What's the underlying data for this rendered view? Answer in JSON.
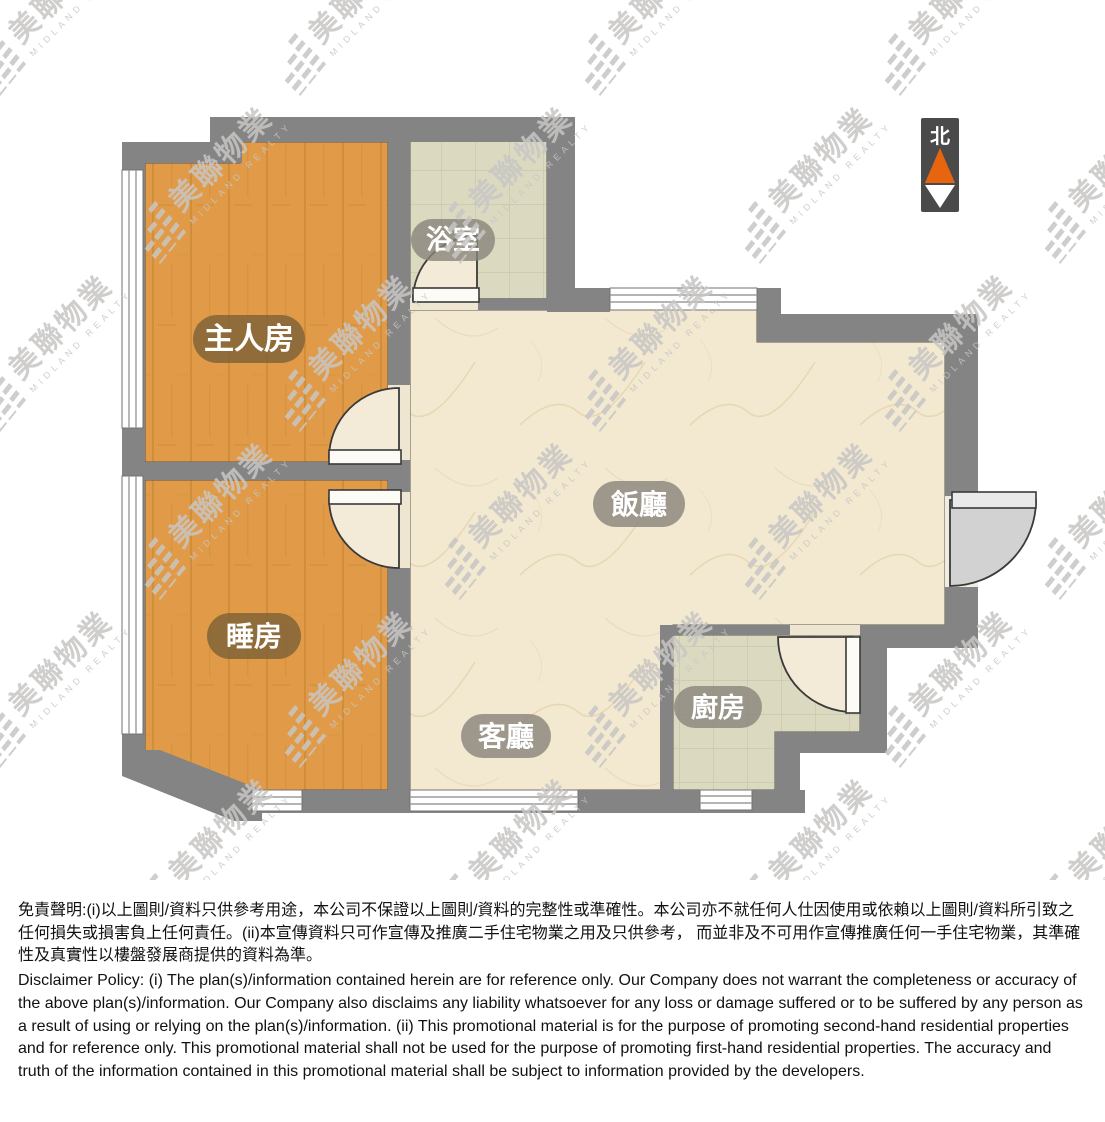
{
  "floor_plan": {
    "rooms": [
      {
        "id": "master-bedroom",
        "label": "主人房"
      },
      {
        "id": "bathroom",
        "label": "浴室"
      },
      {
        "id": "dining-room",
        "label": "飯廳"
      },
      {
        "id": "bedroom",
        "label": "睡房"
      },
      {
        "id": "living-room",
        "label": "客廳"
      },
      {
        "id": "kitchen",
        "label": "廚房"
      }
    ],
    "north_indicator": {
      "label": "北"
    },
    "colors": {
      "wall": "#848484",
      "wood": "#E19B48",
      "wood_grain": "#C07F2C",
      "marble": "#F3E9D1",
      "marble_vein": "#E3D0A6",
      "tile": "#DBDAC1",
      "tile_line": "#C6C5A9",
      "door_swing": "#F3EAD8",
      "pill_brown": "rgba(122,95,55,0.78)",
      "pill_gray": "rgba(136,131,122,0.8)",
      "north_box": "#4A4A4A",
      "north_orange": "#E8650F"
    }
  },
  "watermark": {
    "cjk": "美聯物業",
    "latin": "MIDLAND REALTY"
  },
  "disclaimer": {
    "chinese": "免責聲明:(i)以上圖則/資料只供參考用途，本公司不保證以上圖則/資料的完整性或準確性。本公司亦不就任何人仕因使用或依賴以上圖則/資料所引致之任何損失或損害負上任何責任。(ii)本宣傳資料只可作宣傳及推廣二手住宅物業之用及只供參考， 而並非及不可用作宣傳推廣任何一手住宅物業，其準確性及真實性以樓盤發展商提供的資料為準。",
    "english": "Disclaimer Policy: (i) The plan(s)/information contained herein are for reference only. Our Company does not warrant the completeness or accuracy of the above plan(s)/information. Our Company also disclaims any liability whatsoever for any loss or damage suffered or to be suffered by any person as a result of using or relying on the plan(s)/information. (ii) This promotional material is for the purpose of promoting second-hand residential properties and for reference only. This promotional material shall not be used for the purpose of promoting first-hand residential properties. The accuracy and truth of the information contained in this promotional material shall be subject to information provided by the developers."
  }
}
